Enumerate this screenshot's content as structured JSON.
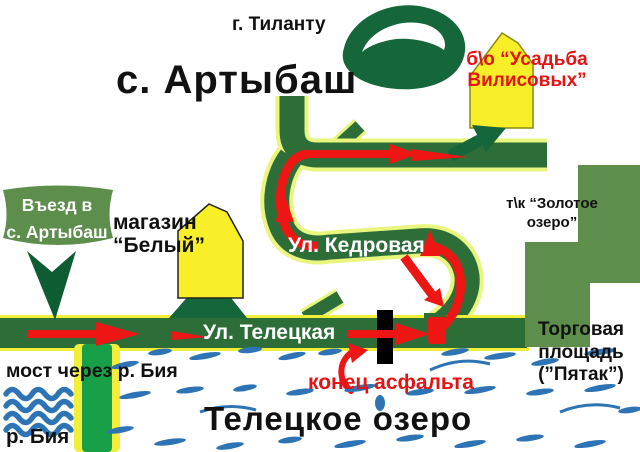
{
  "labels": {
    "mountain": "г. Тиланту",
    "village_title": "с. Артыбаш",
    "usadba": {
      "line1": "б\\о “Усадьба",
      "line2": "Вилисовых”"
    },
    "entrance": {
      "line1": "Въезд в",
      "line2": "с. Артыбаш"
    },
    "shop": {
      "line1": "магазин",
      "line2": "“Белый”"
    },
    "golden_lake": {
      "line1": "т\\к “Золотое",
      "line2": "озеро”"
    },
    "street_kedrovaya": "Ул. Кедровая",
    "street_teletskaya": "Ул. Телецкая",
    "market": {
      "line1": "Торговая",
      "line2": "площадь",
      "line3": "(”Пятак”)"
    },
    "bridge": "мост через р. Бия",
    "river": "р. Бия",
    "lake": "Телецкое озеро",
    "asphalt_end": "конец асфальта"
  },
  "colors": {
    "road_green": "#2d6e38",
    "bright_green": "#18a048",
    "edge_yellow": "#f2ee3a",
    "halo_yellow": "#e9f57d",
    "olive_green": "#5e8e4c",
    "dark_green": "#15663a",
    "darker_green": "#0e5c31",
    "house_yellow": "#f8ef29",
    "route_red": "#ee1515",
    "text_red": "#e21414",
    "water_blue": "#2e74b5",
    "text_black": "#111111",
    "street_white": "#ffffff"
  }
}
